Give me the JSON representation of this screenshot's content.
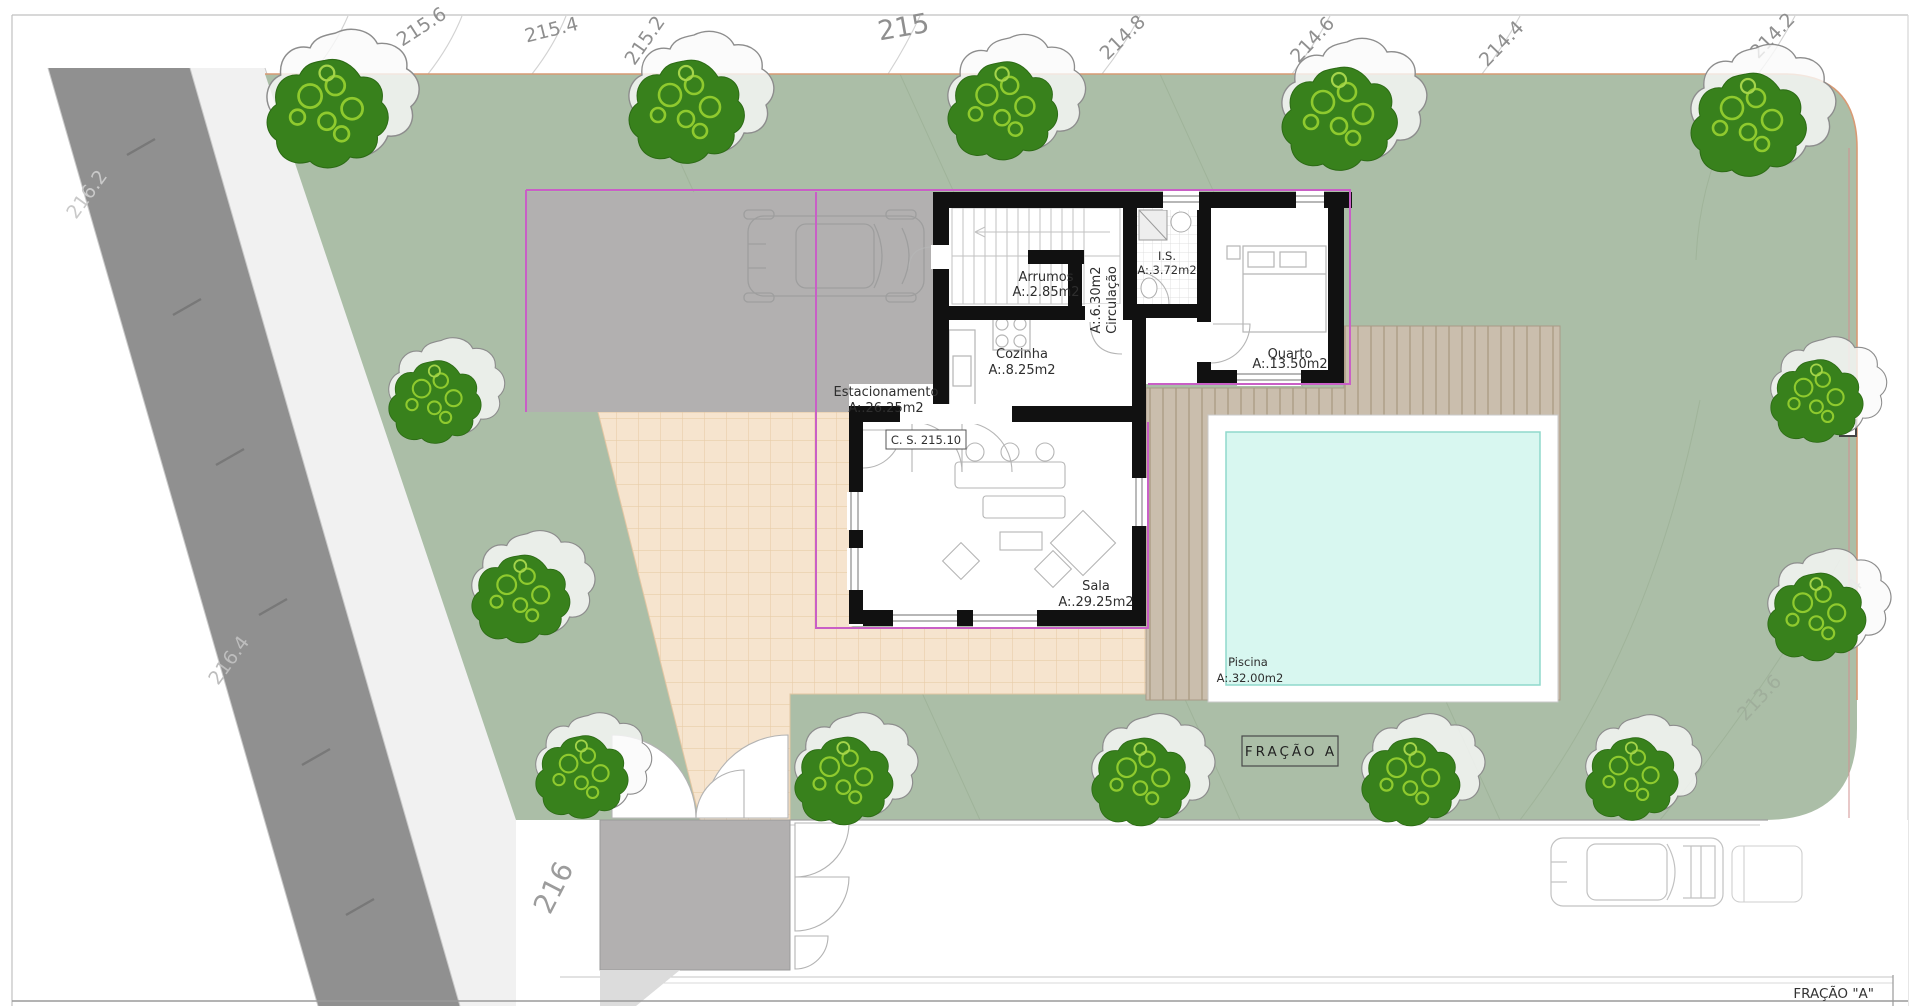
{
  "drawing": {
    "contour_labels": {
      "l215_6": "215.6",
      "l215_4": "215.4",
      "l215_2": "215.2",
      "l215": "215",
      "l214_8": "214.8",
      "l214_6": "214.6",
      "l214_4": "214.4",
      "l214_2": "214.2",
      "l216_2": "216.2",
      "l216_4": "216.4",
      "l216": "216",
      "l213_4": "213.4",
      "l213_6": "213.6"
    },
    "rooms": {
      "estacionamento": {
        "name": "Estacionamento",
        "area": "A:.26.25m2"
      },
      "arrumos": {
        "name": "Arrumos",
        "area": "A:.2.85m2"
      },
      "circulacao": {
        "name": "Circulação",
        "area": "A:.6.30m2"
      },
      "is": {
        "name": "I.S.",
        "area": "A:.3.72m2"
      },
      "quarto": {
        "name": "Quarto",
        "area": "A:.13.50m2"
      },
      "cozinha": {
        "name": "Cozinha",
        "area": "A:.8.25m2"
      },
      "sala": {
        "name": "Sala",
        "area": "A:.29.25m2"
      },
      "piscina": {
        "name": "Piscina",
        "area": "A:.32.00m2"
      }
    },
    "annotations": {
      "cs_level": "C. S. 215.10",
      "fraction_badge": "FRAÇÃO  A",
      "fraction_title": "FRAÇÃO \"A\""
    },
    "colors": {
      "lawn": "#abbea7",
      "road": "#909090",
      "sidewalk": "#f1f1f1",
      "concrete": "#b2b0b0",
      "patio": "#f6e4ce",
      "deck": "#cabead",
      "pool_water": "#d8f7f0",
      "wall": "#111111",
      "boundary_magenta": "#c95fc6",
      "boundary_orange": "#d89a74",
      "tree_dark": "#38811c",
      "tree_light": "#8fca2e"
    }
  }
}
